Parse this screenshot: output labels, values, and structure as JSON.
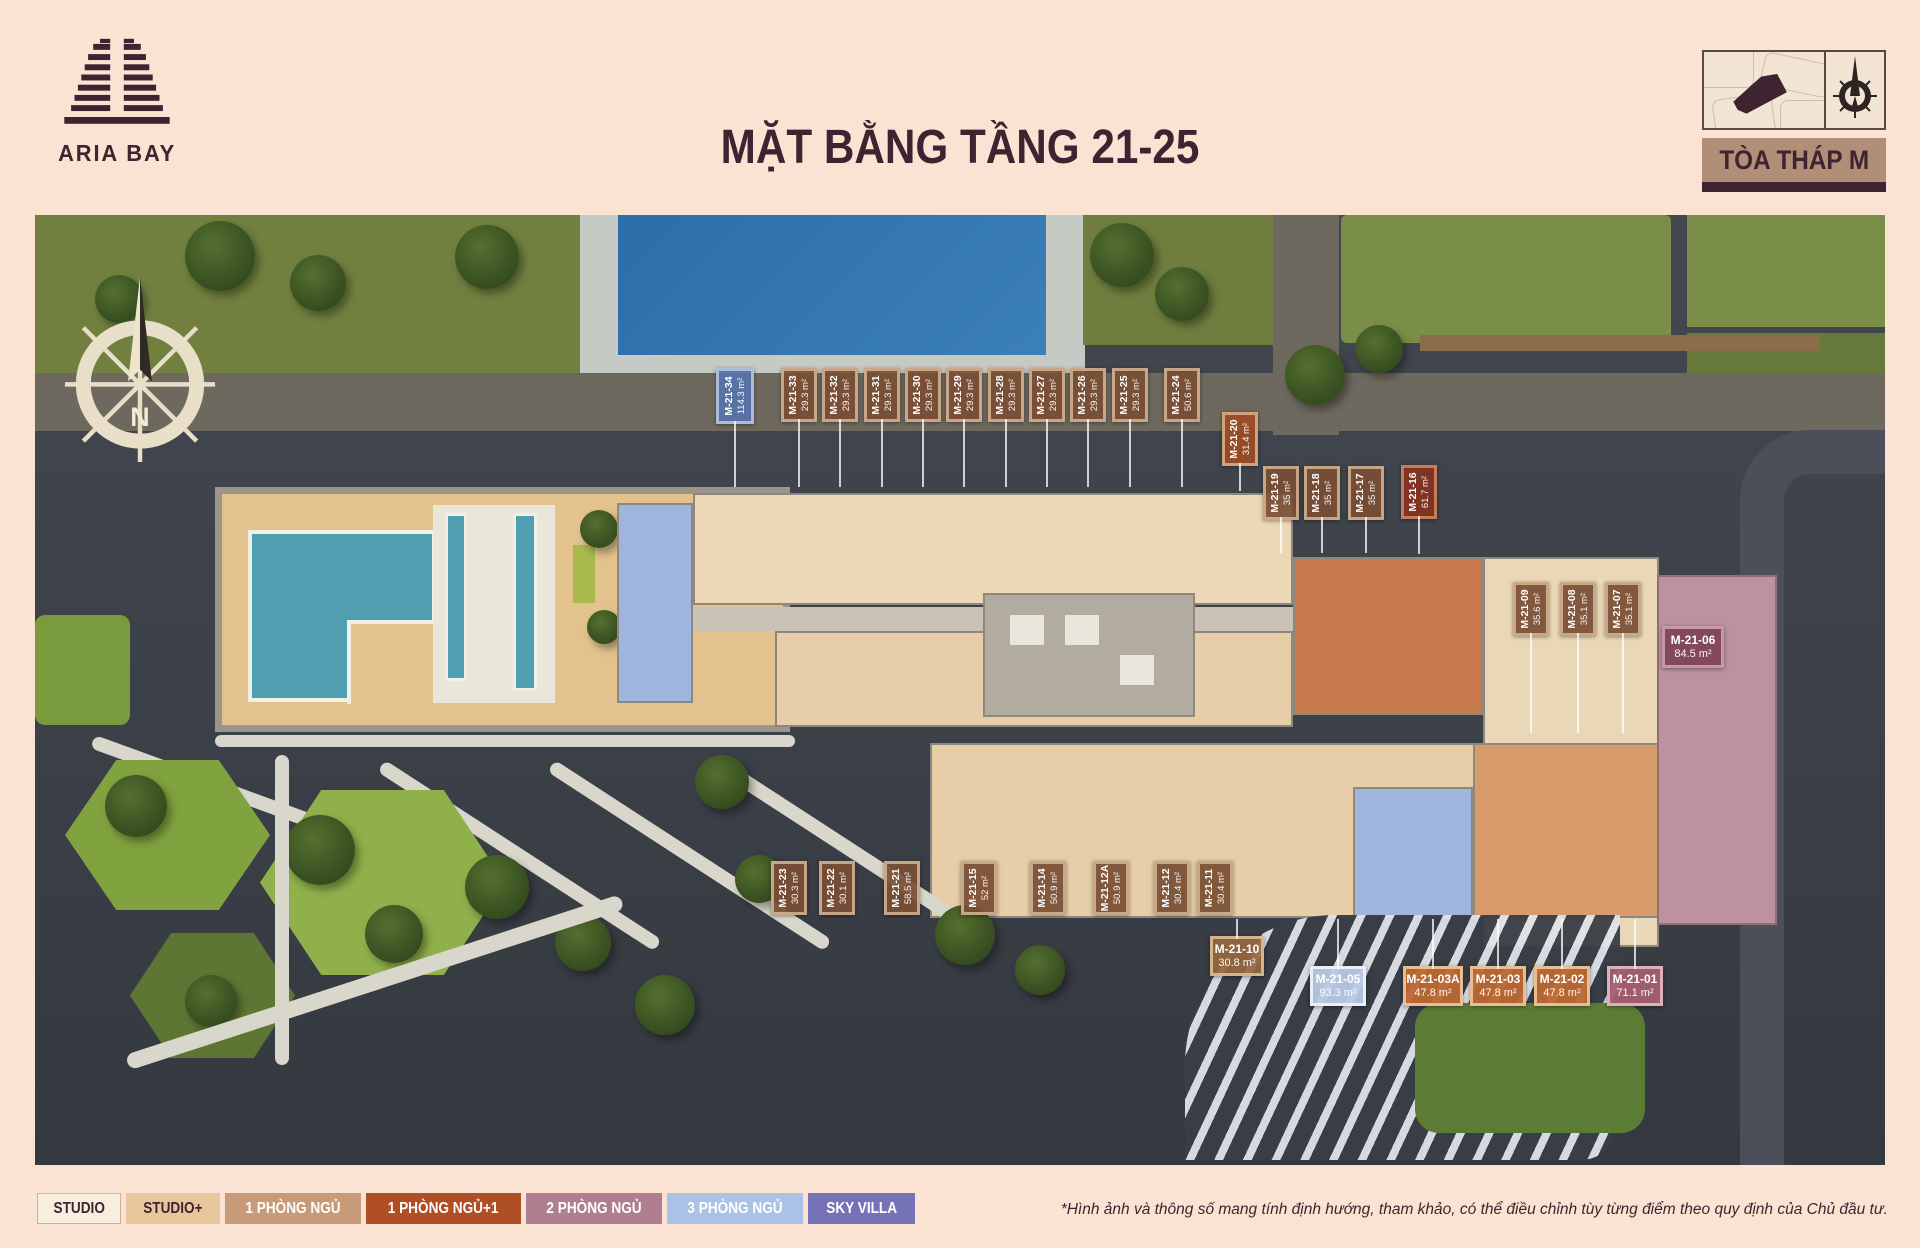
{
  "header": {
    "brand": "ARIA BAY",
    "title": "MẶT BẰNG TẦNG 21-25",
    "tower": "TÒA THÁP M"
  },
  "compass": {
    "label": "N"
  },
  "footer": {
    "disclaimer": "*Hình ảnh và thông số mang tính định hướng, tham khảo, có thể điều chỉnh tùy từng điểm theo quy định của Chủ đầu tư."
  },
  "colors": {
    "page_bg": "#fbe3d4",
    "ink": "#3e2430",
    "tower_bar_bg": "#b08e77",
    "pool": "#4f9fb0",
    "unit_studio_fill": "#ecd8b6",
    "unit_orange_fill": "#c77a4e",
    "unit_blue_fill": "#a0b5dd",
    "unit_mauve_fill": "#bd91a0"
  },
  "label_styles": {
    "brown": {
      "bg": "rgba(122,79,53,0.93)",
      "border": "rgba(219,189,155,0.8)",
      "fg": "#ffffff"
    },
    "blue": {
      "bg": "rgba(86,115,170,0.93)",
      "border": "rgba(186,201,228,0.85)",
      "fg": "#ffffff"
    },
    "rust": {
      "bg": "rgba(153,77,38,0.95)",
      "border": "rgba(224,184,148,0.8)",
      "fg": "#ffffff"
    },
    "darkred": {
      "bg": "rgba(132,50,33,0.95)",
      "border": "rgba(210,145,105,0.8)",
      "fg": "#ffffff"
    },
    "plum": {
      "bg": "rgba(128,68,88,0.95)",
      "border": "rgba(214,173,184,0.8)",
      "fg": "#ffffff"
    },
    "lightblue": {
      "bg": "rgba(184,200,228,0.95)",
      "border": "rgba(240,243,248,0.9)",
      "fg": "#ffffff"
    },
    "orange": {
      "bg": "rgba(188,103,48,0.95)",
      "border": "rgba(238,198,158,0.9)",
      "fg": "#ffffff"
    },
    "mauve": {
      "bg": "rgba(164,94,113,0.95)",
      "border": "rgba(226,186,196,0.9)",
      "fg": "#ffffff"
    },
    "tanh": {
      "bg": "rgba(148,103,63,0.93)",
      "border": "rgba(224,194,158,0.85)",
      "fg": "#ffffff"
    }
  },
  "units": [
    {
      "id": "M-21-34",
      "area": "114.3 m²",
      "style": "blue",
      "orient": "v",
      "x": 716,
      "y": 368,
      "w": 38,
      "h": 56,
      "leader": "down",
      "llen": 66
    },
    {
      "id": "M-21-33",
      "area": "29.3 m²",
      "style": "brown",
      "orient": "v",
      "x": 781,
      "y": 368,
      "w": 36,
      "h": 54,
      "leader": "down",
      "llen": 68
    },
    {
      "id": "M-21-32",
      "area": "29.3 m²",
      "style": "brown",
      "orient": "v",
      "x": 822,
      "y": 368,
      "w": 36,
      "h": 54,
      "leader": "down",
      "llen": 68
    },
    {
      "id": "M-21-31",
      "area": "29.3 m²",
      "style": "brown",
      "orient": "v",
      "x": 864,
      "y": 368,
      "w": 36,
      "h": 54,
      "leader": "down",
      "llen": 68
    },
    {
      "id": "M-21-30",
      "area": "29.3 m²",
      "style": "brown",
      "orient": "v",
      "x": 905,
      "y": 368,
      "w": 36,
      "h": 54,
      "leader": "down",
      "llen": 68
    },
    {
      "id": "M-21-29",
      "area": "29.3 m²",
      "style": "brown",
      "orient": "v",
      "x": 946,
      "y": 368,
      "w": 36,
      "h": 54,
      "leader": "down",
      "llen": 68
    },
    {
      "id": "M-21-28",
      "area": "29.3 m²",
      "style": "brown",
      "orient": "v",
      "x": 988,
      "y": 368,
      "w": 36,
      "h": 54,
      "leader": "down",
      "llen": 68
    },
    {
      "id": "M-21-27",
      "area": "29.3 m²",
      "style": "brown",
      "orient": "v",
      "x": 1029,
      "y": 368,
      "w": 36,
      "h": 54,
      "leader": "down",
      "llen": 68
    },
    {
      "id": "M-21-26",
      "area": "29.3 m²",
      "style": "brown",
      "orient": "v",
      "x": 1070,
      "y": 368,
      "w": 36,
      "h": 54,
      "leader": "down",
      "llen": 68
    },
    {
      "id": "M-21-25",
      "area": "29.3 m²",
      "style": "brown",
      "orient": "v",
      "x": 1112,
      "y": 368,
      "w": 36,
      "h": 54,
      "leader": "down",
      "llen": 68
    },
    {
      "id": "M-21-24",
      "area": "50.6 m²",
      "style": "brown",
      "orient": "v",
      "x": 1164,
      "y": 368,
      "w": 36,
      "h": 54,
      "leader": "down",
      "llen": 68
    },
    {
      "id": "M-21-20",
      "area": "31.4 m²",
      "style": "rust",
      "orient": "v",
      "x": 1222,
      "y": 412,
      "w": 36,
      "h": 54,
      "leader": "down",
      "llen": 28
    },
    {
      "id": "M-21-19",
      "area": "35 m²",
      "style": "brown",
      "orient": "v",
      "x": 1263,
      "y": 466,
      "w": 36,
      "h": 54,
      "leader": "down",
      "llen": 36
    },
    {
      "id": "M-21-18",
      "area": "35 m²",
      "style": "brown",
      "orient": "v",
      "x": 1304,
      "y": 466,
      "w": 36,
      "h": 54,
      "leader": "down",
      "llen": 36
    },
    {
      "id": "M-21-17",
      "area": "35 m²",
      "style": "brown",
      "orient": "v",
      "x": 1348,
      "y": 466,
      "w": 36,
      "h": 54,
      "leader": "down",
      "llen": 36
    },
    {
      "id": "M-21-16",
      "area": "61.7 m²",
      "style": "darkred",
      "orient": "v",
      "x": 1401,
      "y": 465,
      "w": 36,
      "h": 54,
      "leader": "down",
      "llen": 38
    },
    {
      "id": "M-21-09",
      "area": "35.6 m²",
      "style": "brown",
      "orient": "v",
      "x": 1513,
      "y": 582,
      "w": 36,
      "h": 54,
      "leader": "down",
      "llen": 100
    },
    {
      "id": "M-21-08",
      "area": "35.1 m²",
      "style": "brown",
      "orient": "v",
      "x": 1560,
      "y": 582,
      "w": 36,
      "h": 54,
      "leader": "down",
      "llen": 100
    },
    {
      "id": "M-21-07",
      "area": "35.1 m²",
      "style": "brown",
      "orient": "v",
      "x": 1605,
      "y": 582,
      "w": 36,
      "h": 54,
      "leader": "down",
      "llen": 100
    },
    {
      "id": "M-21-06",
      "area": "84.5 m²",
      "style": "plum",
      "orient": "h",
      "x": 1662,
      "y": 626,
      "w": 62,
      "h": 42,
      "leader": null,
      "llen": 0
    },
    {
      "id": "M-21-23",
      "area": "30.3 m²",
      "style": "brown",
      "orient": "v",
      "x": 771,
      "y": 861,
      "w": 36,
      "h": 54,
      "leader": null,
      "llen": 0
    },
    {
      "id": "M-21-22",
      "area": "30.1 m²",
      "style": "brown",
      "orient": "v",
      "x": 819,
      "y": 861,
      "w": 36,
      "h": 54,
      "leader": null,
      "llen": 0
    },
    {
      "id": "M-21-21",
      "area": "58.5 m²",
      "style": "brown",
      "orient": "v",
      "x": 884,
      "y": 861,
      "w": 36,
      "h": 54,
      "leader": null,
      "llen": 0
    },
    {
      "id": "M-21-15",
      "area": "52 m²",
      "style": "brown",
      "orient": "v",
      "x": 961,
      "y": 861,
      "w": 36,
      "h": 54,
      "leader": null,
      "llen": 0
    },
    {
      "id": "M-21-14",
      "area": "50.9 m²",
      "style": "brown",
      "orient": "v",
      "x": 1030,
      "y": 861,
      "w": 36,
      "h": 54,
      "leader": null,
      "llen": 0
    },
    {
      "id": "M-21-12A",
      "area": "50.9 m²",
      "style": "brown",
      "orient": "v",
      "x": 1093,
      "y": 861,
      "w": 36,
      "h": 54,
      "leader": null,
      "llen": 0
    },
    {
      "id": "M-21-12",
      "area": "30.4 m²",
      "style": "brown",
      "orient": "v",
      "x": 1154,
      "y": 861,
      "w": 36,
      "h": 54,
      "leader": null,
      "llen": 0
    },
    {
      "id": "M-21-11",
      "area": "30.4 m²",
      "style": "brown",
      "orient": "v",
      "x": 1197,
      "y": 861,
      "w": 36,
      "h": 54,
      "leader": null,
      "llen": 0
    },
    {
      "id": "M-21-10",
      "area": "30.8 m²",
      "style": "tanh",
      "orient": "h",
      "x": 1210,
      "y": 936,
      "w": 54,
      "h": 40,
      "leader": "up",
      "llen": 20
    },
    {
      "id": "M-21-05",
      "area": "93.3 m²",
      "style": "lightblue",
      "orient": "h",
      "x": 1310,
      "y": 966,
      "w": 56,
      "h": 40,
      "leader": "up",
      "llen": 50
    },
    {
      "id": "M-21-03A",
      "area": "47.8 m²",
      "style": "orange",
      "orient": "h",
      "x": 1403,
      "y": 966,
      "w": 60,
      "h": 40,
      "leader": "up",
      "llen": 50
    },
    {
      "id": "M-21-03",
      "area": "47.8 m²",
      "style": "orange",
      "orient": "h",
      "x": 1470,
      "y": 966,
      "w": 56,
      "h": 40,
      "leader": "up",
      "llen": 50
    },
    {
      "id": "M-21-02",
      "area": "47.8 m²",
      "style": "orange",
      "orient": "h",
      "x": 1534,
      "y": 966,
      "w": 56,
      "h": 40,
      "leader": "up",
      "llen": 50
    },
    {
      "id": "M-21-01",
      "area": "71.1 m²",
      "style": "mauve",
      "orient": "h",
      "x": 1607,
      "y": 966,
      "w": 56,
      "h": 40,
      "leader": "up",
      "llen": 50
    }
  ],
  "legend": [
    {
      "label": "STUDIO",
      "bg": "#f7eedd",
      "fg": "#3e2430",
      "border": "#c9b49b"
    },
    {
      "label": "STUDIO+",
      "bg": "#e9c79d",
      "fg": "#3e2430",
      "border": "#e9c79d"
    },
    {
      "label": "1 PHÒNG NGỦ",
      "bg": "#c79a79",
      "fg": "#ffffff",
      "border": "#c79a79"
    },
    {
      "label": "1 PHÒNG NGỦ+1",
      "bg": "#b04e26",
      "fg": "#ffffff",
      "border": "#b04e26"
    },
    {
      "label": "2 PHÒNG NGỦ",
      "bg": "#b07e91",
      "fg": "#ffffff",
      "border": "#b07e91"
    },
    {
      "label": "3 PHÒNG NGỦ",
      "bg": "#a9c2e6",
      "fg": "#ffffff",
      "border": "#a9c2e6"
    },
    {
      "label": "SKY VILLA",
      "bg": "#7672b8",
      "fg": "#ffffff",
      "border": "#7672b8"
    }
  ]
}
